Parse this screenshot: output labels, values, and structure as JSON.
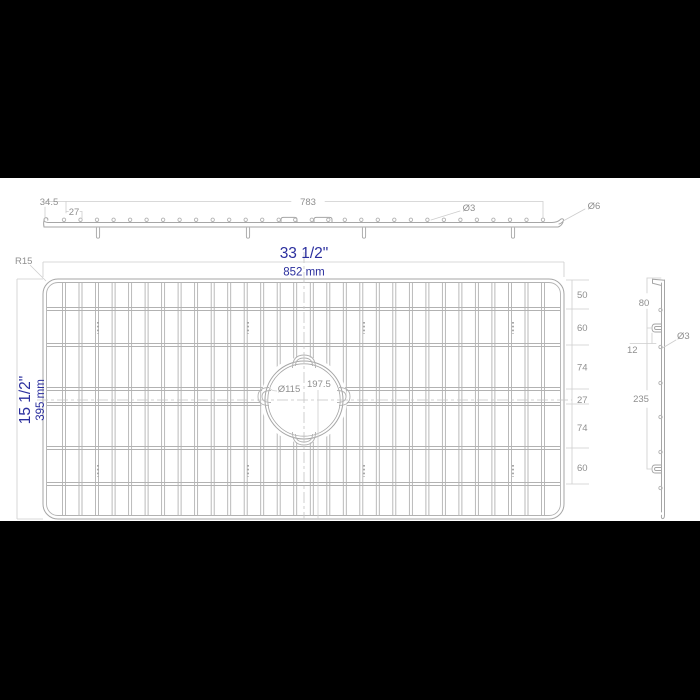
{
  "drawing": {
    "colors": {
      "background": "#ffffff",
      "letterbox": "#000000",
      "wire_line": "#b2b2b2",
      "frame_line": "#a6a6a6",
      "dim_line": "#cdcdcd",
      "dim_text": "#8f8f8f",
      "accent_blue": "#2b2f9e"
    },
    "front_view": {
      "dim_edge_to_first_wire": "34.5",
      "dim_wire_pitch": "27",
      "dim_wire_span": "783",
      "dim_wire_diameter": "Ø3",
      "dim_frame_diameter": "Ø6",
      "wire_count": 30,
      "feet_count": 4
    },
    "plan_view": {
      "width_inch": "33 1/2\"",
      "width_mm": "852 mm",
      "height_inch": "15 1/2\"",
      "height_mm": "395 mm",
      "corner_radius": "R15",
      "hole_diameter": "Ø115",
      "hole_center_offset": "197.5",
      "row_gaps": [
        "50",
        "60",
        "74",
        "27",
        "74",
        "60"
      ],
      "vertical_wire_count": 30,
      "horizontal_wire_count": 6,
      "feet_mark_count": 4
    },
    "side_view": {
      "dim_top_to_hook": "80",
      "dim_hook_offset": "12",
      "dim_wire_diameter": "Ø3",
      "dim_hook_span": "235",
      "wire_count": 6,
      "hook_count": 2
    }
  }
}
